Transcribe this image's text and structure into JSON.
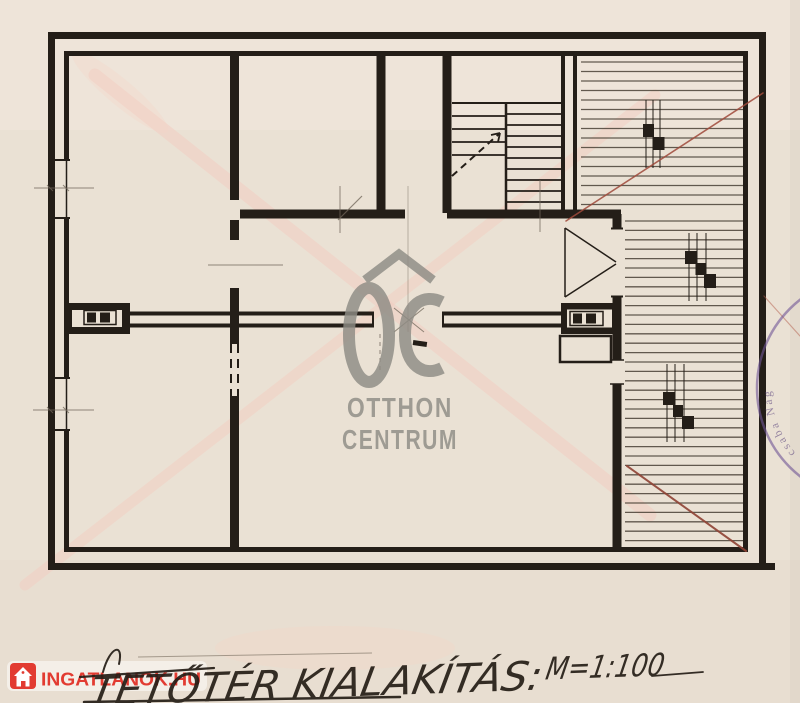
{
  "plan": {
    "ink_color": "#241e18",
    "paper_color": "#eae1d4",
    "red_line_color": "#a04a3b",
    "crease_color": "#f3cec2",
    "features": [
      "outer-double-walls",
      "interior-walls",
      "staircase",
      "hatched-roof-area",
      "chimney-symbols",
      "window-openings",
      "door-openings"
    ]
  },
  "watermarks": {
    "otthon_centrum": {
      "monogram": "OC",
      "word1": "OTTHON",
      "word2": "CENTRUM",
      "color": "#8e8c85"
    },
    "ingatlanok": {
      "label": "INGATLANOK.HU",
      "color": "#e23b31"
    }
  },
  "stamp": {
    "visible_text": "csaba Nag",
    "color": "#6f5596"
  },
  "title_block": {
    "handwritten_title": "TETŐTÉR KIALAKÍTÁS:",
    "scale_note": "M=1:100",
    "ink": "#241d16"
  }
}
